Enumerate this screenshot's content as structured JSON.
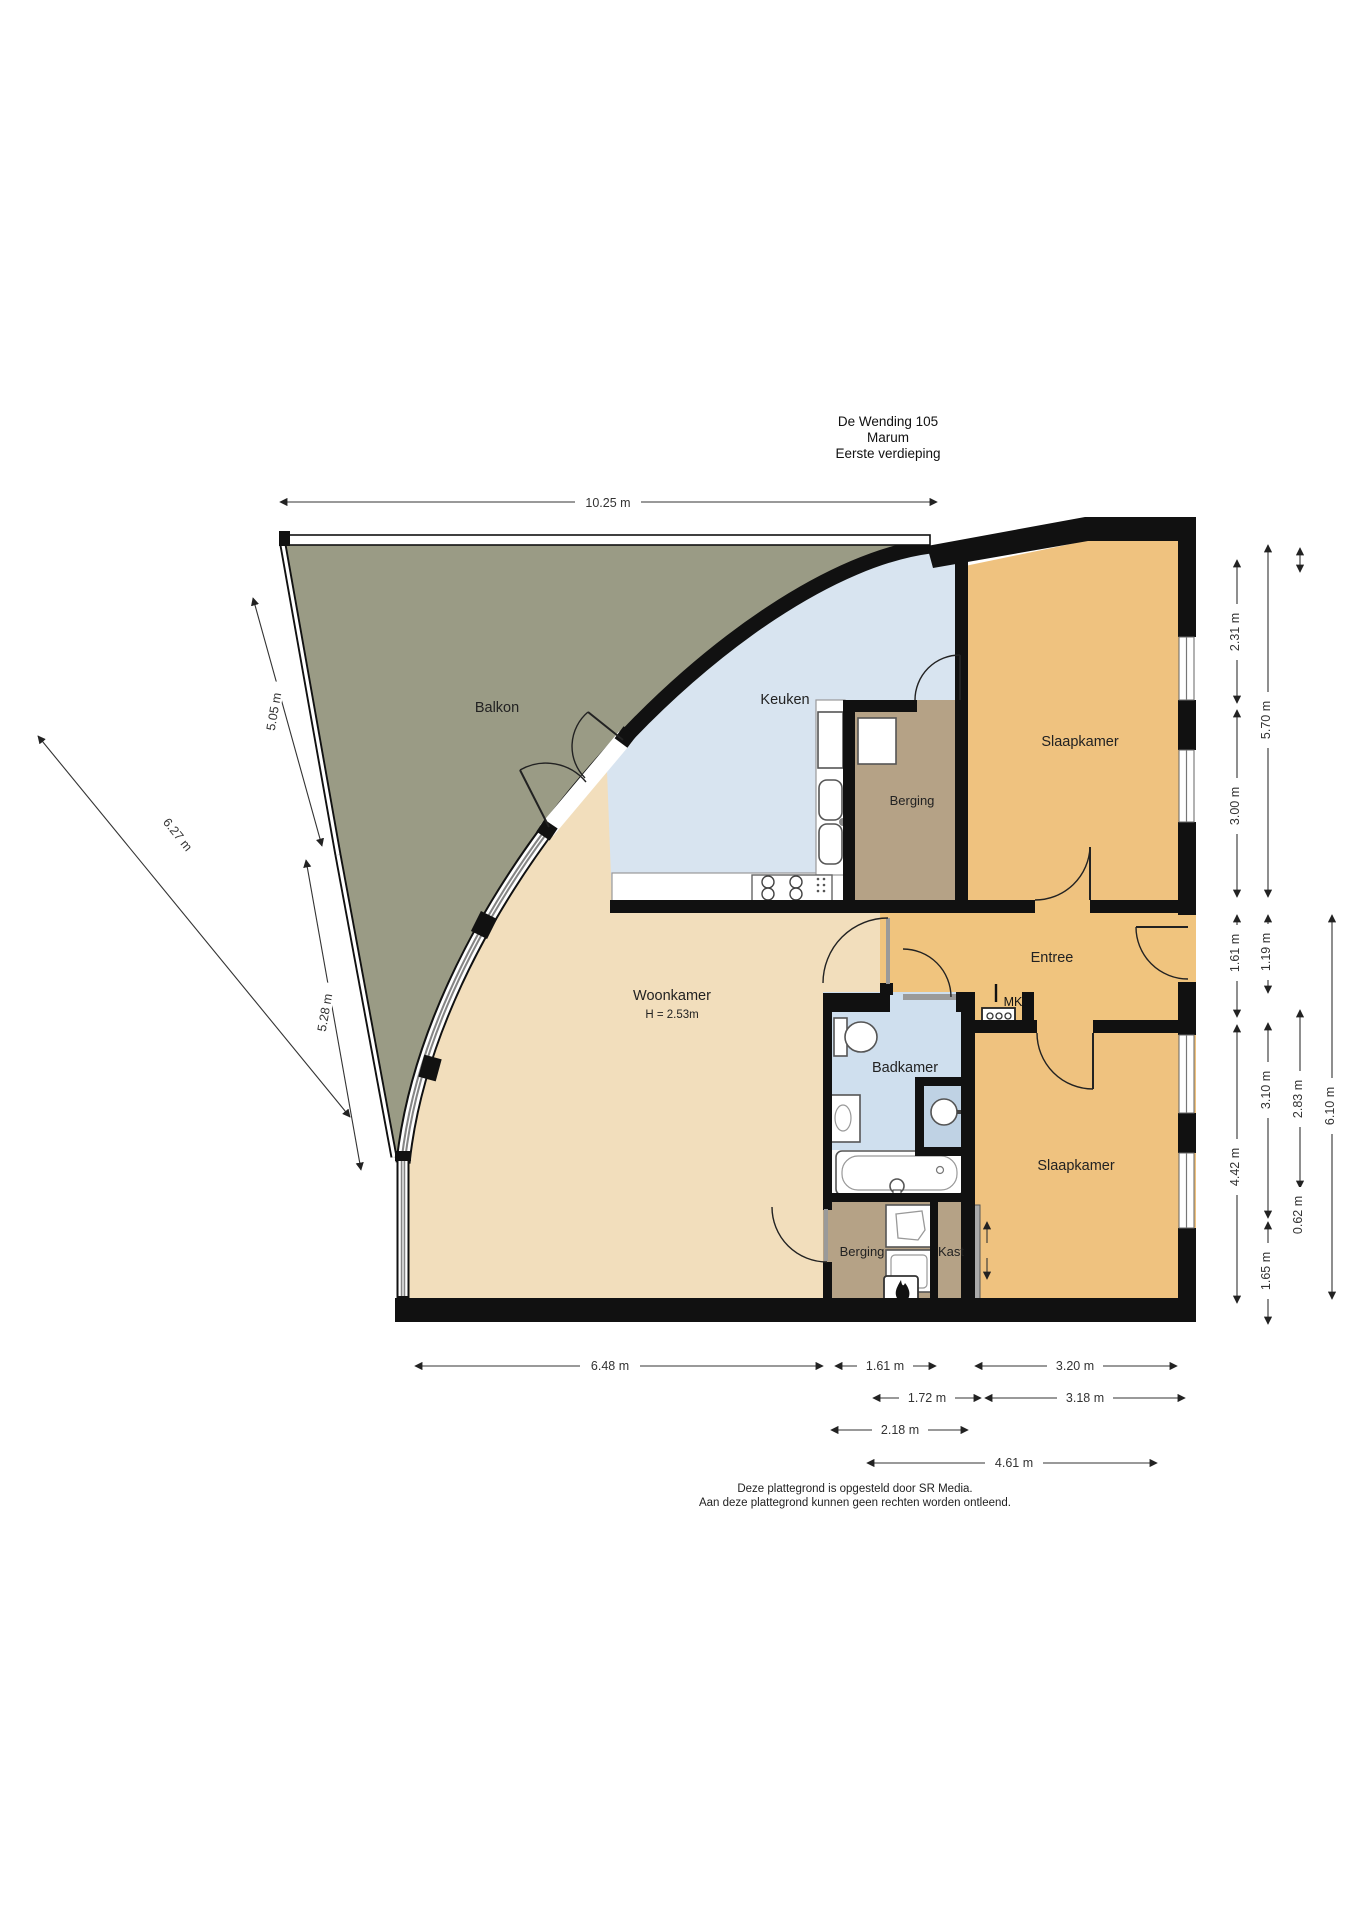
{
  "title": {
    "line1": "De Wending 105",
    "line2": "Marum",
    "line3": "Eerste verdieping"
  },
  "rooms": {
    "balkon": "Balkon",
    "keuken": "Keuken",
    "berging_top": "Berging",
    "slaapkamer_top": "Slaapkamer",
    "entree": "Entree",
    "mk": "MK",
    "woonkamer": "Woonkamer",
    "woonkamer_height": "H = 2.53m",
    "badkamer": "Badkamer",
    "slaapkamer_bottom": "Slaapkamer",
    "berging_bottom": "Berging",
    "kast": "Kast"
  },
  "dimensions": {
    "top": "10.25 m",
    "left": {
      "d505": "5.05 m",
      "d528": "5.28 m",
      "d627": "6.27 m"
    },
    "right": {
      "d231": "2.31 m",
      "d300": "3.00 m",
      "d570": "5.70 m",
      "d161": "1.61 m",
      "d119": "1.19 m",
      "d442": "4.42 m",
      "d310": "3.10 m",
      "d283": "2.83 m",
      "d610": "6.10 m",
      "d062": "0.62 m",
      "d165": "1.65 m"
    },
    "bottom": {
      "d648": "6.48 m",
      "d161": "1.61 m",
      "d320": "3.20 m",
      "d172": "1.72 m",
      "d318": "3.18 m",
      "d218": "2.18 m",
      "d461": "4.61 m"
    }
  },
  "footer": {
    "line1": "Deze plattegrond is opgesteld door SR Media.",
    "line2": "Aan deze plattegrond kunnen geen rechten worden ontleend."
  },
  "colors": {
    "balkon": "#9A9B85",
    "woonkamer": "#F2DEBC",
    "keuken": "#D8E4F0",
    "badkamer": "#CFDFEE",
    "shower": "#BFD2E4",
    "slaapkamer": "#EFC27F",
    "entree": "#F0C47E",
    "berging": "#B5A286",
    "wall": "#111111"
  }
}
